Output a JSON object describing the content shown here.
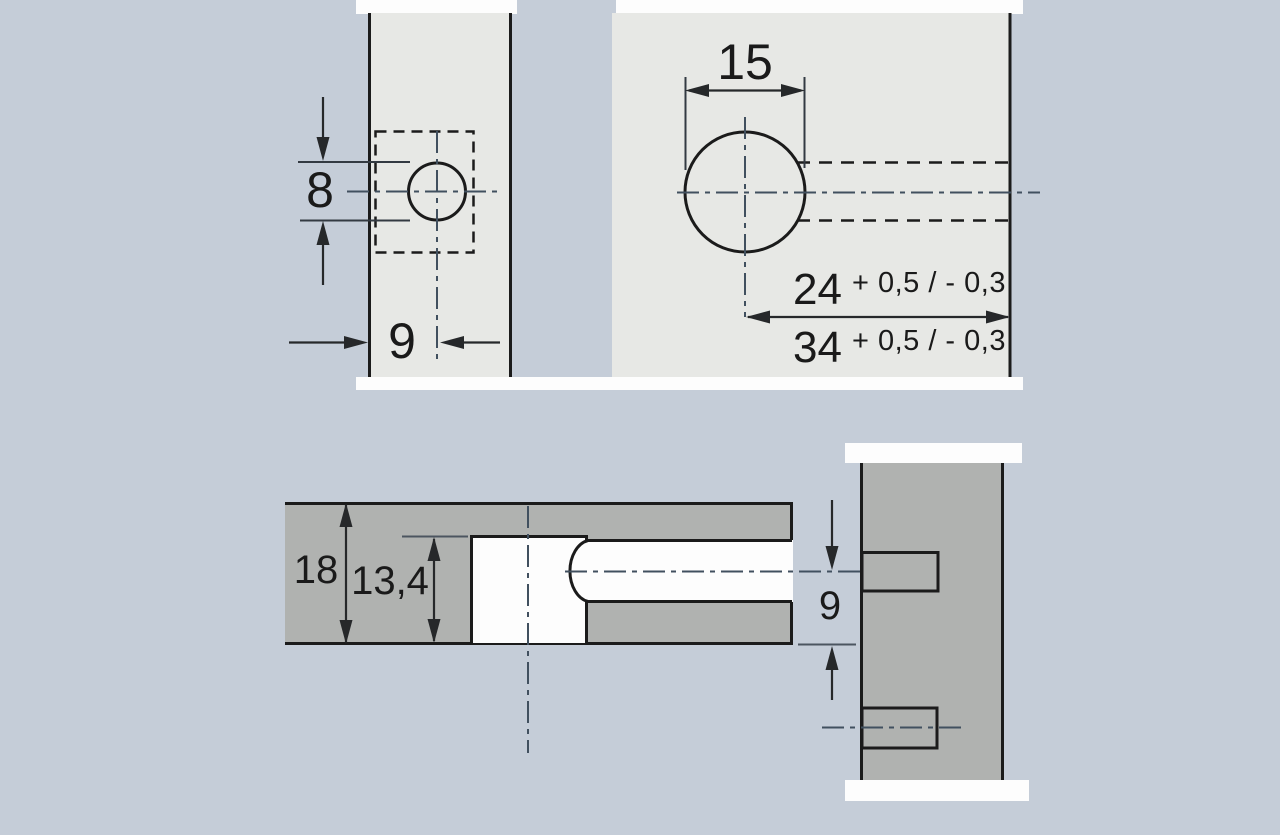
{
  "colors": {
    "bg": "#c5cdd8",
    "panel_light": "#e7e8e5",
    "panel_dark": "#b0b2b0",
    "white": "#fdfdfd",
    "line": "#1b1b1b",
    "dimline": "#26282a",
    "extline": "#4c5560",
    "centerline": "#41505f",
    "text": "#1a1a1a"
  },
  "top_view": {
    "hole_diameter_label": "8",
    "edge_distance_label": "9",
    "cup_diameter_label": "15",
    "distance_24_value": "24",
    "distance_24_tolerance": "+ 0,5 / - 0,3",
    "distance_34_value": "34",
    "distance_34_tolerance": "+ 0,5 / - 0,3"
  },
  "section_view": {
    "panel_thickness_label": "18",
    "drilling_depth_label": "13,4",
    "offset_label": "9"
  }
}
